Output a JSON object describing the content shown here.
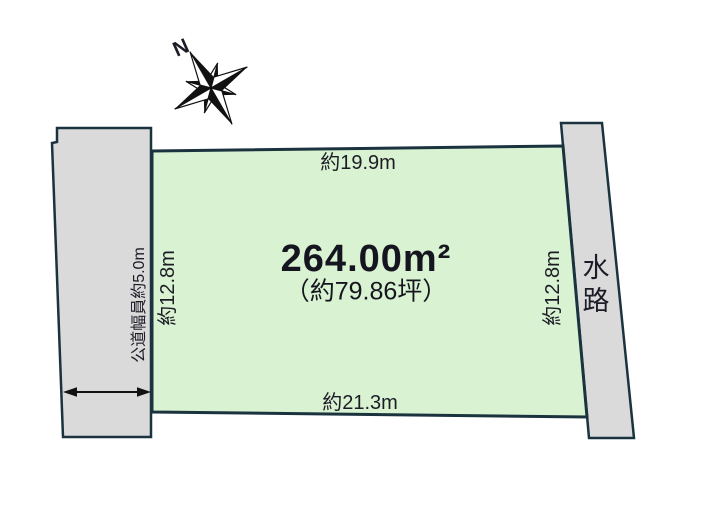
{
  "page": {
    "background_color": "#ffffff",
    "outline_color": "#1a333e",
    "text_color": "#1c1c26"
  },
  "compass": {
    "north_label": "N"
  },
  "plot": {
    "area_label": "264.00m²",
    "area_tsubo_label": "（約79.86坪）",
    "top_dimension": "約19.9m",
    "bottom_dimension": "約21.3m",
    "left_dimension": "約12.8m",
    "right_dimension": "約12.8m",
    "fill_color": "#d9f2d1"
  },
  "road": {
    "width_label": "公道幅員約5.0m",
    "fill_color": "#dadada"
  },
  "waterway": {
    "label": "水路",
    "fill_color": "#dadada"
  }
}
